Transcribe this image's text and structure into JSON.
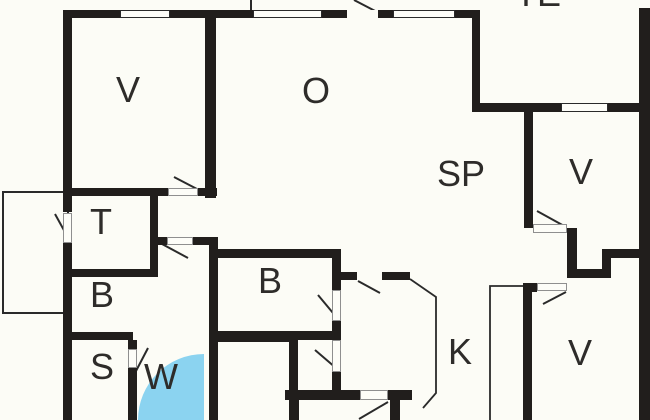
{
  "rooms": {
    "v_top_left": {
      "label": "V"
    },
    "o_living": {
      "label": "O"
    },
    "te_terrace": {
      "label": "TE"
    },
    "sp_dining": {
      "label": "SP"
    },
    "v_right_upper": {
      "label": "V"
    },
    "t_room": {
      "label": "T"
    },
    "b_left": {
      "label": "B"
    },
    "b_center": {
      "label": "B"
    },
    "s_room": {
      "label": "S"
    },
    "w_bath": {
      "label": "W"
    },
    "k_kitchen": {
      "label": "K"
    },
    "v_right_lower": {
      "label": "V"
    }
  },
  "colors": {
    "wall": "#211e1c",
    "background": "#fcfcf6",
    "shower_fill": "#8bd3f0",
    "label_text": "#2e2c2a",
    "window_outline": "#2a2a2a"
  }
}
